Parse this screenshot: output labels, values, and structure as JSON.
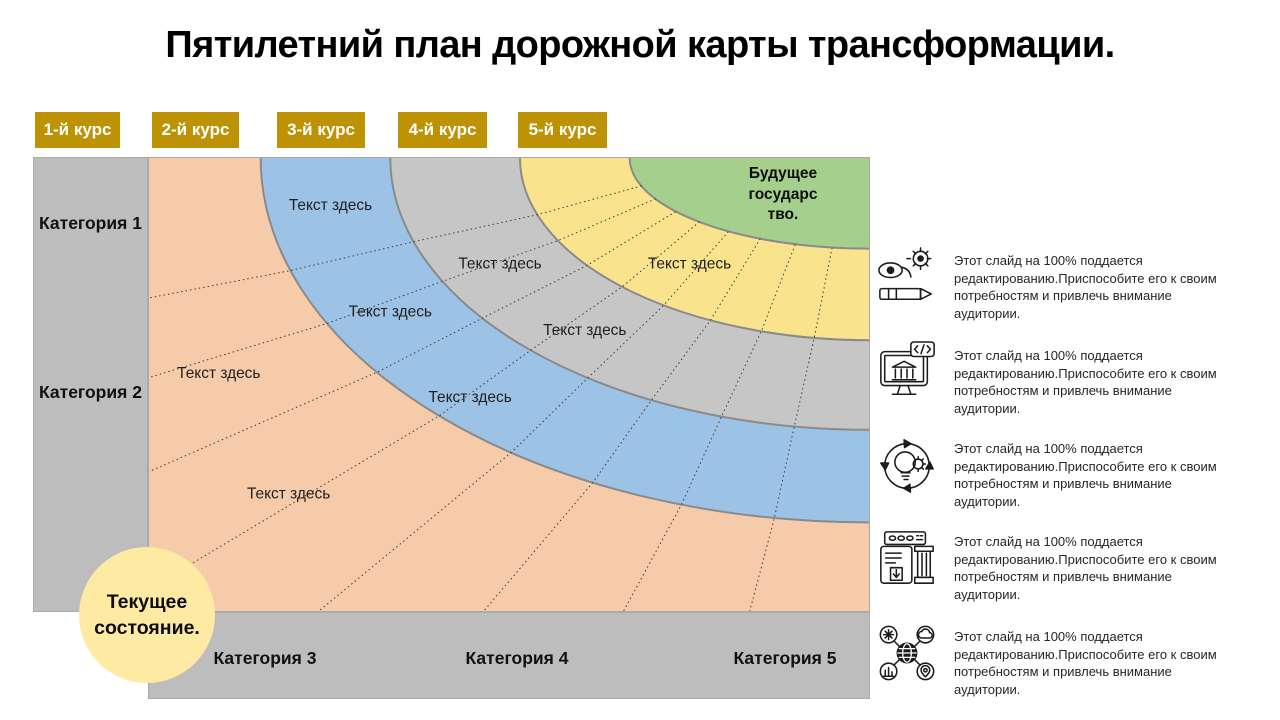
{
  "title": "Пятилетний план дорожной карты трансформации.",
  "courses": [
    "1-й курс",
    "2-й курс",
    "3-й курс",
    "4-й курс",
    "5-й курс"
  ],
  "categories": {
    "rows": [
      "Категория 1",
      "Категория 2"
    ],
    "cols": [
      "Категория 3",
      "Категория 4",
      "Категория 5"
    ]
  },
  "diagram": {
    "future_state": {
      "label": "Будущее государс тво.",
      "lines": [
        "Будущее",
        "государс",
        "тво."
      ]
    },
    "current_state": {
      "label": "Текущее состояние.",
      "lines": [
        "Текущее",
        "состояние."
      ]
    },
    "ring_labels": [
      "Текст здесь",
      "Текст здесь",
      "Текст здесь",
      "Текст здесь",
      "Текст здесь",
      "Текст здесь",
      "Текст здесь",
      "Текст здесь"
    ],
    "rings": [
      {
        "name": "ring-orange",
        "color": "#F6CBA9"
      },
      {
        "name": "ring-blue",
        "color": "#9CC2E5"
      },
      {
        "name": "ring-gray",
        "color": "#C6C6C6"
      },
      {
        "name": "ring-yellow",
        "color": "#FAE38D"
      },
      {
        "name": "ring-green",
        "color": "#A5CF8D"
      }
    ]
  },
  "notes": {
    "items": [
      {
        "icon": "vision-gear-pencil-icon",
        "text": "Этот слайд на 100% поддается редактированию.Приспособите  его к своим потребностям и привлечь  внимание аудитории."
      },
      {
        "icon": "monitor-building-code-icon",
        "text": "Этот слайд на 100% поддается редактированию.Приспособите  его к своим потребностям и привлечь  внимание аудитории."
      },
      {
        "icon": "lightbulb-gear-cycle-icon",
        "text": "Этот слайд на 100% поддается редактированию.Приспособите  его к своим потребностям и привлечь  внимание аудитории."
      },
      {
        "icon": "archive-column-icon",
        "text": "Этот слайд на 100% поддается редактированию.Приспособите  его к своим потребностям и привлечь  внимание аудитории."
      },
      {
        "icon": "globe-network-icon",
        "text": "Этот слайд на 100% поддается редактированию.Приспособите  его к своим потребностям и привлечь  внимание аудитории."
      }
    ]
  },
  "colors": {
    "accent_gold": "#BD9204",
    "panel_gray": "#BDBDBD",
    "circle_yellow": "#FFEAA4",
    "ring_border": "#8A8A8A",
    "divider_line": "#3E3A35"
  }
}
